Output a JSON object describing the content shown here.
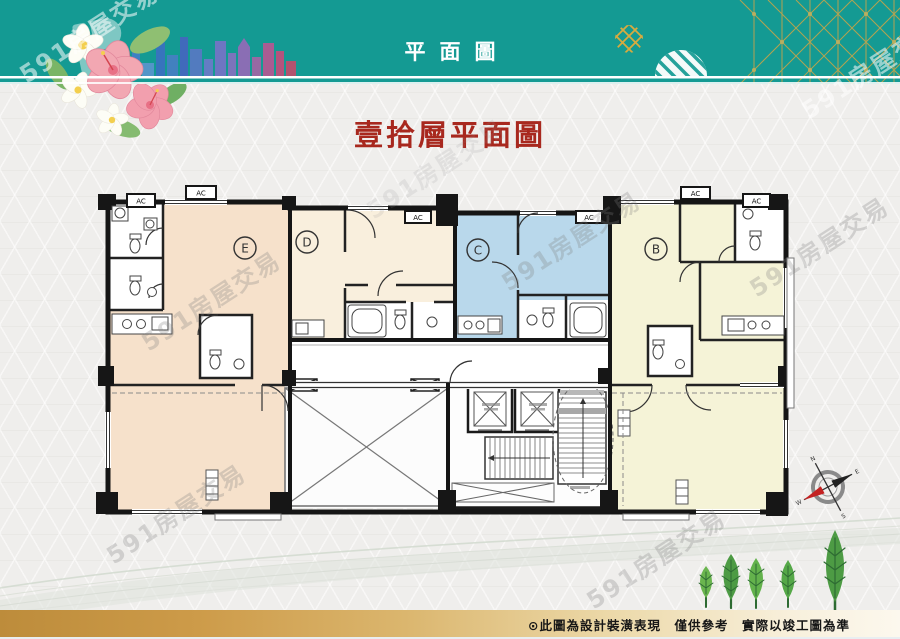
{
  "header": {
    "title": "平面圖"
  },
  "main_title": {
    "text": "壹拾層平面圖",
    "color": "#a8281e"
  },
  "watermark": {
    "text": "591房屋交易"
  },
  "plan": {
    "ac_label": "AC",
    "units": [
      {
        "label": "E",
        "color": "#f6e1cb"
      },
      {
        "label": "D",
        "color": "#f9efdd"
      },
      {
        "label": "C",
        "color": "#b9d8eb"
      },
      {
        "label": "B",
        "color": "#f5f3d7"
      }
    ]
  },
  "compass": {
    "n": "N",
    "e": "E",
    "s": "S",
    "w": "W"
  },
  "footer": {
    "disclaimer": "⊙此圖為設計裝潢表現　僅供參考　實際以竣工圖為準"
  },
  "colors": {
    "header_teal": "#149a93",
    "title_red": "#a8281e",
    "footer_gold": "#cd9b49",
    "background": "#efeeec",
    "wall": "#161616",
    "tree_green": "#55a848"
  }
}
